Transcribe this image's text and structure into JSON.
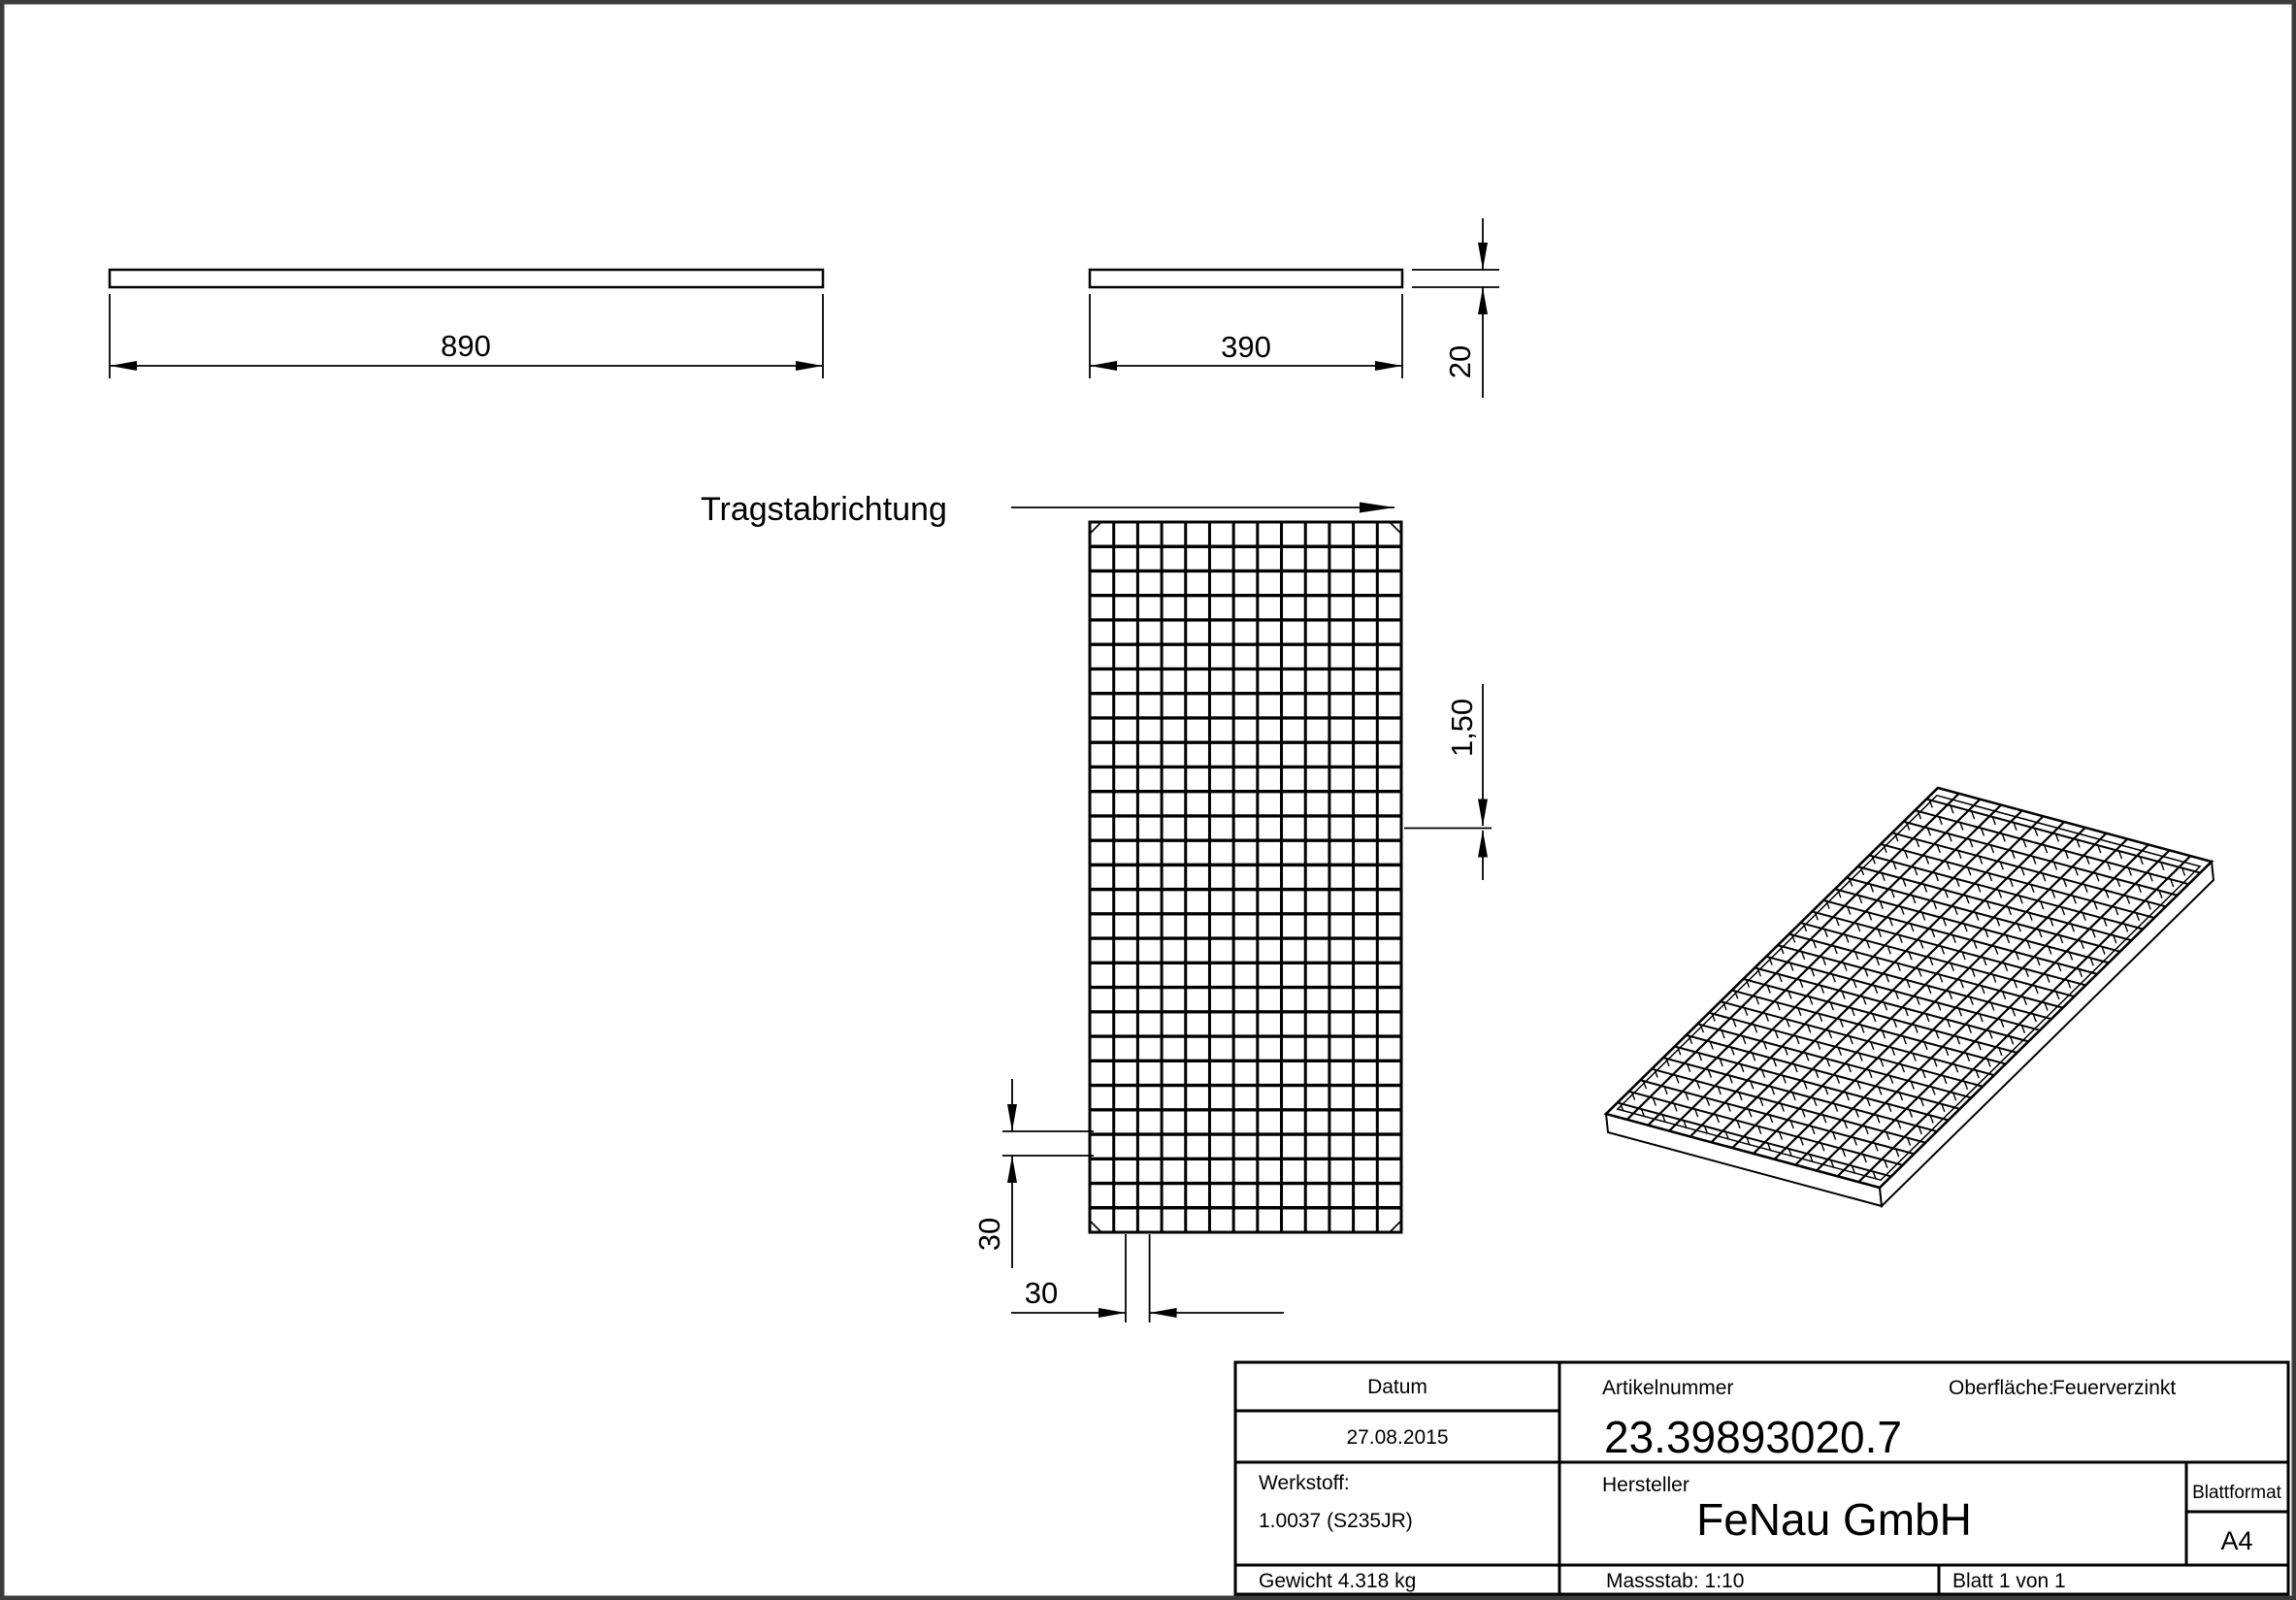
{
  "sheet": {
    "background": "#ffffff",
    "frame_color": "#3b3b3b",
    "line_color": "#000000"
  },
  "views": {
    "side_view_long": {
      "length_dim": "890"
    },
    "side_view_short": {
      "width_dim": "390",
      "height_dim": "20"
    },
    "front_view": {
      "direction_label": "Tragstabrichtung",
      "bearing_bar_thickness_dim": "1,50",
      "mesh_pitch_vertical_dim": "30",
      "mesh_pitch_horizontal_dim": "30",
      "mesh_cols": 13,
      "mesh_rows": 29
    },
    "iso_view": {
      "mesh_cols": 13,
      "mesh_rows": 29
    }
  },
  "title_block": {
    "datum_label": "Datum",
    "datum_value": "27.08.2015",
    "artikelnummer_label": "Artikelnummer",
    "artikelnummer_value": "23.39893020.7",
    "oberflaeche_label": "Oberfläche:",
    "oberflaeche_value": "Feuerverzinkt",
    "werkstoff_label": "Werkstoff:",
    "werkstoff_value": "1.0037 (S235JR)",
    "hersteller_label": "Hersteller",
    "hersteller_value": "FeNau GmbH",
    "blattformat_label": "Blattformat",
    "blattformat_value": "A4",
    "gewicht_text": "Gewicht 4.318 kg",
    "massstab_text": "Massstab: 1:10",
    "blatt_text": "Blatt 1 von 1"
  }
}
